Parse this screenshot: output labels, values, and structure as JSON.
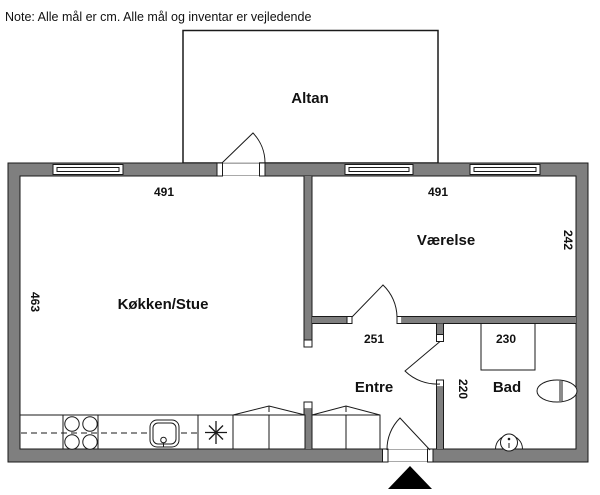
{
  "note": "Note: Alle mål er cm. Alle mål og inventar er vejledende",
  "rooms": {
    "altan": "Altan",
    "kokken_stue": "Køkken/Stue",
    "vaerelse": "Værelse",
    "entre": "Entre",
    "bad": "Bad"
  },
  "dims": {
    "kokken_width": "491",
    "vaerelse_width": "491",
    "kokken_depth": "463",
    "vaerelse_depth": "242",
    "entre_width": "251",
    "bad_width": "230",
    "bad_depth": "220"
  },
  "fixtures": {
    "stove": "stove-4-burner-icon",
    "sink": "kitchen-sink-icon",
    "hob": "asterisk-appliance-icon",
    "wardrobes": "wardrobe-cabinet-icon",
    "shower": "shower-icon",
    "toilet": "toilet-icon",
    "washbasin": "washbasin-icon",
    "entrance_marker": "entrance-arrow-icon"
  },
  "colors": {
    "wall_fill": "#7f7f7f",
    "line": "#1a1a1a",
    "background": "#ffffff"
  }
}
